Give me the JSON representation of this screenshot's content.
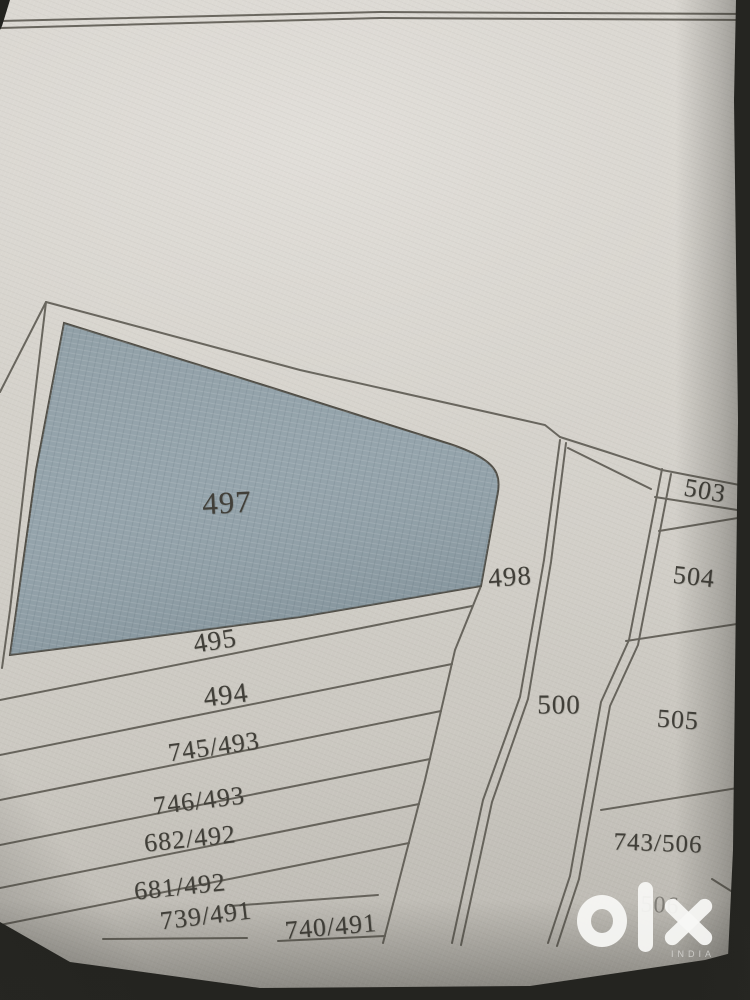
{
  "map": {
    "description": "Photographed hand-drawn cadastral survey plot map",
    "highlighted_plot": "497",
    "plots": [
      {
        "label": "497",
        "x": 227,
        "y": 503,
        "rot": -3,
        "size": 31,
        "shaded": true
      },
      {
        "label": "498",
        "x": 510,
        "y": 577,
        "rot": -4,
        "size": 27,
        "shaded": false
      },
      {
        "label": "495",
        "x": 215,
        "y": 641,
        "rot": -9,
        "size": 27,
        "shaded": false
      },
      {
        "label": "494",
        "x": 226,
        "y": 696,
        "rot": -7,
        "size": 28,
        "shaded": false
      },
      {
        "label": "745/493",
        "x": 214,
        "y": 747,
        "rot": -8,
        "size": 26,
        "shaded": false
      },
      {
        "label": "746/493",
        "x": 199,
        "y": 801,
        "rot": -7,
        "size": 26,
        "shaded": false
      },
      {
        "label": "682/492",
        "x": 190,
        "y": 839,
        "rot": -6,
        "size": 26,
        "shaded": false
      },
      {
        "label": "681/492",
        "x": 180,
        "y": 887,
        "rot": -6,
        "size": 26,
        "shaded": false
      },
      {
        "label": "739/491",
        "x": 206,
        "y": 916,
        "rot": -7,
        "size": 26,
        "shaded": false
      },
      {
        "label": "740/491",
        "x": 331,
        "y": 927,
        "rot": -5,
        "size": 26,
        "shaded": false
      },
      {
        "label": "500",
        "x": 559,
        "y": 705,
        "rot": 0,
        "size": 27,
        "shaded": false
      },
      {
        "label": "503",
        "x": 705,
        "y": 491,
        "rot": 10,
        "size": 26,
        "shaded": false
      },
      {
        "label": "504",
        "x": 694,
        "y": 577,
        "rot": 6,
        "size": 26,
        "shaded": false
      },
      {
        "label": "505",
        "x": 678,
        "y": 720,
        "rot": 4,
        "size": 26,
        "shaded": false
      },
      {
        "label": "743/506",
        "x": 658,
        "y": 844,
        "rot": 2,
        "size": 25,
        "shaded": false
      },
      {
        "label": "506",
        "x": 660,
        "y": 906,
        "rot": 3,
        "size": 24,
        "faint": true,
        "shaded": false
      }
    ]
  },
  "watermark": {
    "brand": "olx",
    "country": "INDIA"
  },
  "colors": {
    "paper": "#d4d1ca",
    "shaded_plot": "#95a4ac",
    "line": "#55524a",
    "label": "#413f39",
    "photo_edge": "#23231f",
    "watermark": "#f8f8f5"
  }
}
